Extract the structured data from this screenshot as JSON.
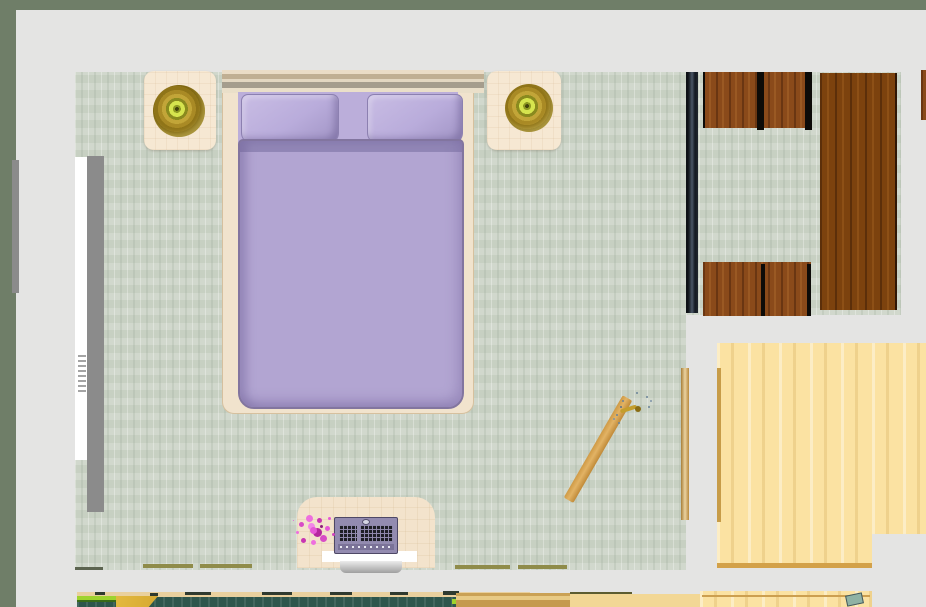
{
  "scene": {
    "kind": "top-down floor plan render",
    "room": "bedroom with adjacent hallway",
    "view": "overhead orthographic"
  },
  "colors": {
    "background": "#e4e4e3",
    "wall_accent": "#6f7e68",
    "carpet": "#ccd4c7",
    "bed_frame": "#f1e3cd",
    "duvet": "#b2a5d2",
    "duvet_shadow": "#82759f",
    "pillow": "#b9acdb",
    "nightstand": "#f6e8d3",
    "lamp_gold": "#a98a25",
    "lamp_glow": "#d6e44e",
    "dark_wood": "#8a4a1a",
    "wardrobe_wood": "#7c420e",
    "wood_floor": "#fbe2a2",
    "door_wood": "#e2b365",
    "door_frame": "#c79c48",
    "divider_dark": "#1c2128",
    "cabinet_gray": "#8b8b8b",
    "cabinet_white": "#ffffff",
    "desk": "#f3e3cc",
    "laptop_body": "#938bb0",
    "laptop_keys": "#1e1e26",
    "flowers_pink": "#e659d6",
    "paper_white": "#ffffff",
    "balcony_teal": "#2e564c",
    "balcony_green": "#9ed32e",
    "balcony_gold": "#d6a932"
  },
  "furniture": [
    {
      "id": "double-bed",
      "kind": "bed with lavender duvet and two pillows"
    },
    {
      "id": "nightstand-left",
      "kind": "bedside table with gold lamp"
    },
    {
      "id": "nightstand-right",
      "kind": "bedside table with gold lamp"
    },
    {
      "id": "left-wall-cabinet",
      "kind": "white and gray cabinet strip"
    },
    {
      "id": "dark-divider",
      "kind": "dark panel divider"
    },
    {
      "id": "wood-seat-group-top",
      "kind": "dark wood chairs"
    },
    {
      "id": "wood-seat-group-bottom",
      "kind": "dark wood chairs"
    },
    {
      "id": "wardrobe",
      "kind": "tall dark wood wardrobe"
    },
    {
      "id": "open-door",
      "kind": "wood door swung open with handle"
    },
    {
      "id": "desk",
      "kind": "desk with laptop and pink bouquet"
    },
    {
      "id": "laptop",
      "kind": "purple laptop"
    },
    {
      "id": "flower-bouquet",
      "kind": "pink flowers"
    },
    {
      "id": "hall-floor",
      "kind": "light wood floor of adjacent room"
    }
  ]
}
